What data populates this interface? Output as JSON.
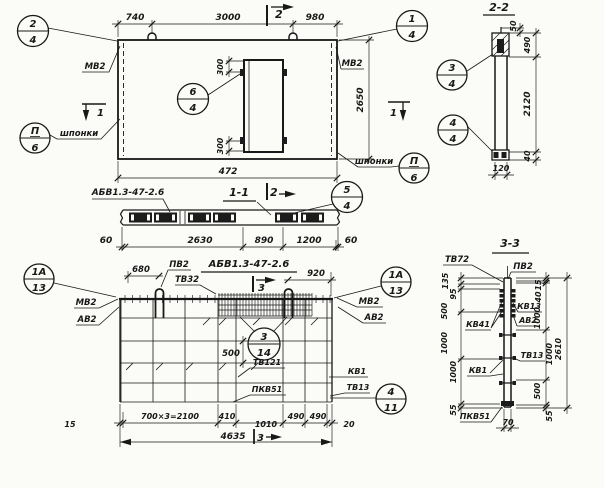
{
  "plan": {
    "callout_2_4": {
      "top": "2",
      "bottom": "4"
    },
    "callout_1_4": {
      "top": "1",
      "bottom": "4"
    },
    "callout_6_4": {
      "top": "6",
      "bottom": "4"
    },
    "callout_3_4": {
      "top": "3",
      "bottom": "4"
    },
    "callout_4_4": {
      "top": "4",
      "bottom": "4"
    },
    "callout_p6_left": {
      "top": "П",
      "bottom": "6"
    },
    "callout_p6_right": {
      "top": "П",
      "bottom": "6"
    },
    "dim_740": "740",
    "dim_3000": "3000",
    "dim_980": "980",
    "dim_2650": "2650",
    "dim_472": "472",
    "dim_300_top": "300",
    "dim_300_bottom": "300",
    "label_mv2_left": "МВ2",
    "label_mv2_right": "МВ2",
    "label_shponki_left": "шпонки",
    "label_shponki_right": "шпонки",
    "cut1_left": "1",
    "cut1_right": "1",
    "cut2_top": "2"
  },
  "section_2_2": {
    "title": "2-2",
    "dim_50": "50",
    "dim_490": "490",
    "dim_2120": "2120",
    "dim_40": "40",
    "dim_120": "120"
  },
  "section_1_1": {
    "title": "1-1",
    "cut2": "2",
    "label_panel": "АБВ1.3-47-2.6",
    "callout_5_4": {
      "top": "5",
      "bottom": "4"
    },
    "dim_60_left": "60",
    "dim_2630": "2630",
    "dim_890": "890",
    "dim_1200": "1200",
    "dim_60_right": "60"
  },
  "elevation": {
    "title": "АБВ1.3-47-2.6",
    "cut3_top": "3",
    "cut3_bottom": "3",
    "dim_680": "680",
    "dim_920": "920",
    "dim_500": "500",
    "label_pv2": "ПВ2",
    "label_tv32": "ТВ32",
    "label_mv2_left": "МВ2",
    "label_av2_left": "АВ2",
    "label_mv2_right": "МВ2",
    "label_av2_right": "АВ2",
    "label_tv121": "ТВ121",
    "label_pkv51": "ПКВ51",
    "label_kv1": "КВ1",
    "label_tv13": "ТВ13",
    "callout_1a_13_left": {
      "top": "1А",
      "bottom": "13"
    },
    "callout_1a_13_right": {
      "top": "1А",
      "bottom": "13"
    },
    "callout_3_14": {
      "top": "3",
      "bottom": "14"
    },
    "callout_4_11": {
      "top": "4",
      "bottom": "11"
    },
    "dim_15": "15",
    "dim_700x3": "700×3=2100",
    "dim_410": "410",
    "dim_1010": "1010",
    "dim_490_a": "490",
    "dim_490_b": "490",
    "dim_20": "20",
    "dim_4635": "4635"
  },
  "section_3_3": {
    "title": "3-3",
    "label_tv72": "ТВ72",
    "label_pv2": "ПВ2",
    "label_kv13": "КВ13",
    "label_av2": "АВ2",
    "label_kv41": "КВ41",
    "label_tv13": "ТВ13",
    "label_kv1": "КВ1",
    "label_pkv51": "ПКВ51",
    "d135": "135",
    "d95": "95",
    "d500": "500",
    "d1000_a": "1000",
    "d1000_b": "1000",
    "d55": "55",
    "d70": "70",
    "r15": "15",
    "r40": "40",
    "r1000_a": "1000",
    "r1000_b": "1000",
    "r500": "500",
    "r55": "55",
    "r2610": "2610"
  }
}
